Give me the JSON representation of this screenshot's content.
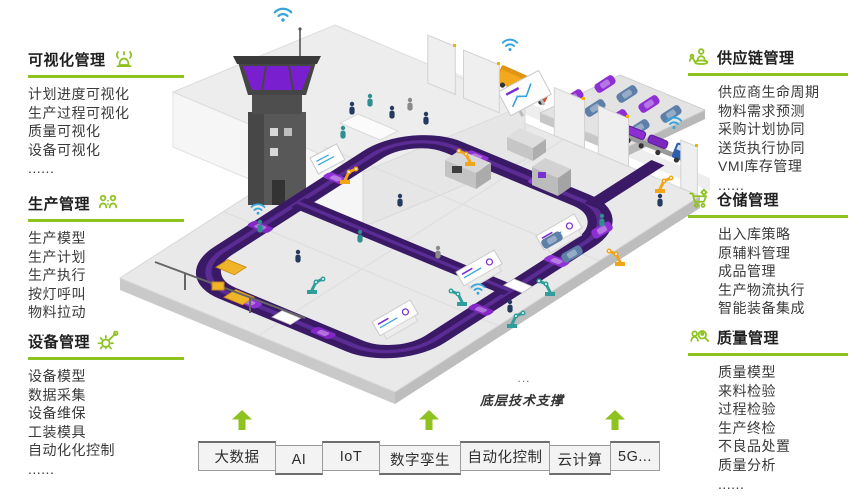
{
  "colors": {
    "accent_green": "#8dc21f",
    "conveyor_purple": "#3a1a66",
    "car_purple": "#9132d6",
    "wifi_blue": "#35a3dc",
    "heading_text": "#1f1f1f",
    "body_text": "#3a3a3a",
    "bar_background": "#f3f3f3",
    "bar_border": "#6e6e6e"
  },
  "left_sections": [
    {
      "title": "可视化管理",
      "icon": "beacon-icon",
      "items": [
        "计划进度可视化",
        "生产过程可视化",
        "质量可视化",
        "设备可视化",
        "......"
      ]
    },
    {
      "title": "生产管理",
      "icon": "team-icon",
      "items": [
        "生产模型",
        "生产计划",
        "生产执行",
        "按灯呼叫",
        "物料拉动",
        "......"
      ]
    },
    {
      "title": "设备管理",
      "icon": "gear-wrench-icon",
      "items": [
        "设备模型",
        "数据采集",
        "设备维保",
        "工装模具",
        "自动化化控制",
        "......"
      ]
    }
  ],
  "right_sections": [
    {
      "title": "供应链管理",
      "icon": "supplier-icon",
      "items": [
        "供应商生命周期",
        "物料需求预测",
        "采购计划协同",
        "送货执行协同",
        "VMI库存管理",
        "......"
      ]
    },
    {
      "title": "仓储管理",
      "icon": "cart-icon",
      "items": [
        "出入库策略",
        "原辅料管理",
        "成品管理",
        "生产物流执行",
        "智能装备集成",
        "......"
      ]
    },
    {
      "title": "质量管理",
      "icon": "inspection-icon",
      "items": [
        "质量模型",
        "来料检验",
        "过程检验",
        "生产终检",
        "不良品处置",
        "质量分析",
        "......"
      ]
    }
  ],
  "bottom_bar": {
    "dots": "...",
    "caption": "底层技术支撑",
    "technologies": [
      "大数据",
      "AI",
      "IoT",
      "数字孪生",
      "自动化控制",
      "云计算",
      "5G..."
    ]
  },
  "illustration": {
    "elements": [
      "control-tower",
      "wifi-signal",
      "mezzanine-office",
      "presentation-screen",
      "conveyor-loop",
      "robot-arm",
      "agv-shuttle",
      "car-body",
      "warehouse-wall",
      "parking-lot",
      "delivery-truck",
      "car-transporter",
      "display-kiosk",
      "worker"
    ]
  }
}
